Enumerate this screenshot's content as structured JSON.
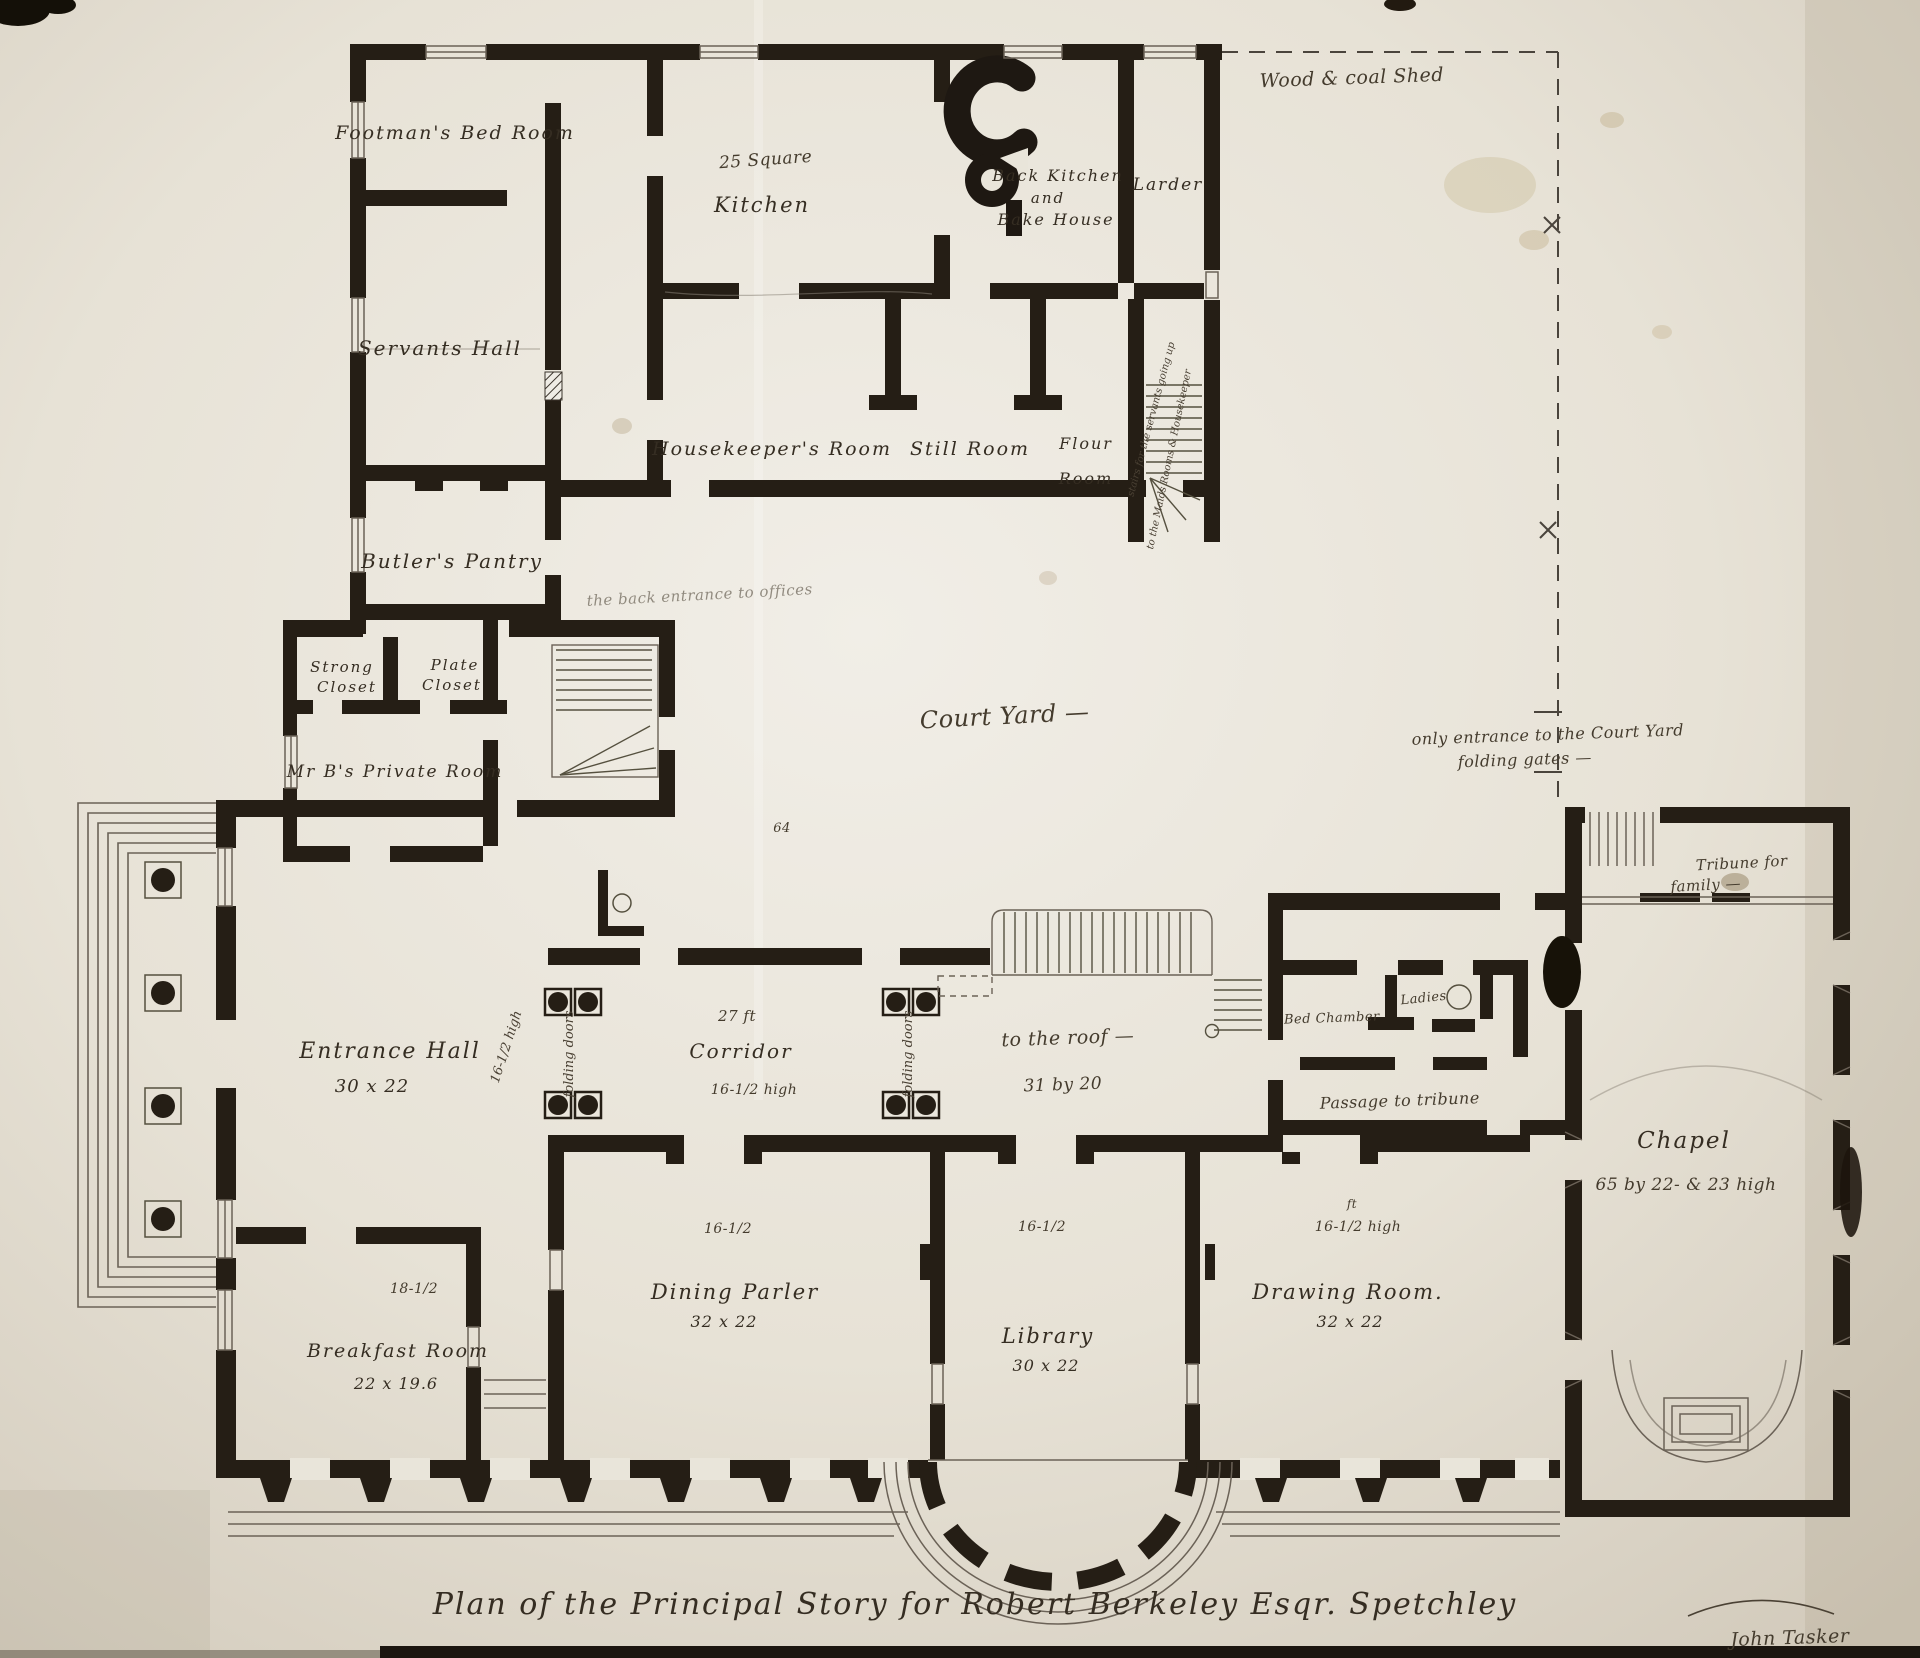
{
  "drawing": {
    "title": "Plan of the Principal Story for Robert Berkeley Esqr.   Spetchley",
    "signature": "John Tasker"
  },
  "colors": {
    "ink": "#251e15",
    "paper": "#e9e5da",
    "thin_line": "#6b6257"
  },
  "labels": {
    "footmans_bed_room": "Footman's Bed Room",
    "servants_hall": "Servants Hall",
    "butlers_pantry": "Butler's Pantry",
    "kitchen_size": "25 Square",
    "kitchen": "Kitchen",
    "back_kitchen_1": "Back Kitchen",
    "back_kitchen_2": "and",
    "back_kitchen_3": "Bake House",
    "larder": "Larder",
    "wood_coal_shed": "Wood & coal Shed",
    "housekeepers_room": "Housekeeper's Room",
    "still_room": "Still Room",
    "flour_room_1": "Flour",
    "flour_room_2": "Room",
    "back_stairs_note_1": "stairs for the servants going up",
    "back_stairs_note_2": "to the Maids Rooms & Housekeeper",
    "back_entrance_note": "the back entrance to offices",
    "strong_closet_1": "Strong",
    "strong_closet_2": "Closet",
    "plate_closet_1": "Plate",
    "plate_closet_2": "Closet",
    "mr_bs_private_room": "Mr B's Private Room",
    "court_yard": "Court Yard —",
    "courtyard_entrance_1": "only entrance to the Court Yard",
    "courtyard_entrance_2": "folding gates —",
    "stair_number": "64",
    "entrance_hall": "Entrance Hall",
    "entrance_hall_size": "30 x 22",
    "corridor_ft": "27 ft",
    "corridor": "Corridor",
    "corridor_height": "16-1/2 high",
    "folding_doors": "folding doors",
    "hall_height_note": "16-1/2 high",
    "stair_hall_1": "to the roof —",
    "stair_hall_2": "31 by 20",
    "bed_chamber": "Bed Chamber",
    "ladies": "Ladies",
    "passage_tribune": "Passage to tribune",
    "tribune_1": "Tribune for",
    "tribune_2": "family —",
    "chapel": "Chapel",
    "chapel_size": "65 by 22- & 23 high",
    "dining_height": "16-1/2",
    "dining_parler": "Dining Parler",
    "dining_size": "32 x 22",
    "library_height": "16-1/2",
    "library": "Library",
    "library_size": "30 x 22",
    "drawing_ft": "ft",
    "drawing_height": "16-1/2 high",
    "drawing_room": "Drawing Room.",
    "drawing_size": "32 x 22",
    "breakfast_height": "18-1/2",
    "breakfast_room": "Breakfast Room",
    "breakfast_size": "22 x 19.6"
  }
}
